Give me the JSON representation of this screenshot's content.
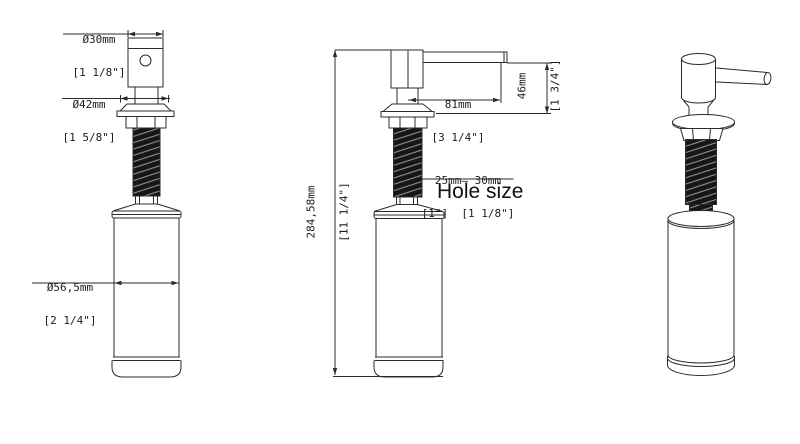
{
  "page": {
    "background": "#ffffff",
    "line_color": "#2b2b2b",
    "text_color": "#1c1c1c",
    "thread_fill": "#161616"
  },
  "views": {
    "front": "front orthographic view",
    "side": "side orthographic view",
    "iso": "isometric rendered view"
  },
  "dimensions": {
    "head_diameter": {
      "metric": "Ø30mm",
      "imperial": "[1 1/8\"]"
    },
    "flange_diameter": {
      "metric": "Ø42mm",
      "imperial": "[1 5/8\"]"
    },
    "bottle_diameter": {
      "metric": "Ø56,5mm",
      "imperial": "[2 1/4\"]"
    },
    "spout_reach": {
      "metric": "81mm",
      "imperial": "[3 1/4\"]"
    },
    "spout_height": {
      "metric": "46mm",
      "imperial": "[1 3/4\"]"
    },
    "total_height": {
      "metric": "284,58mm",
      "imperial": "[11 1/4\"]"
    },
    "hole_size": {
      "range_metric": "25mm— 30mm",
      "range_imperial": "[1\"]  [1 1/8\"]",
      "label": "Hole size"
    }
  }
}
